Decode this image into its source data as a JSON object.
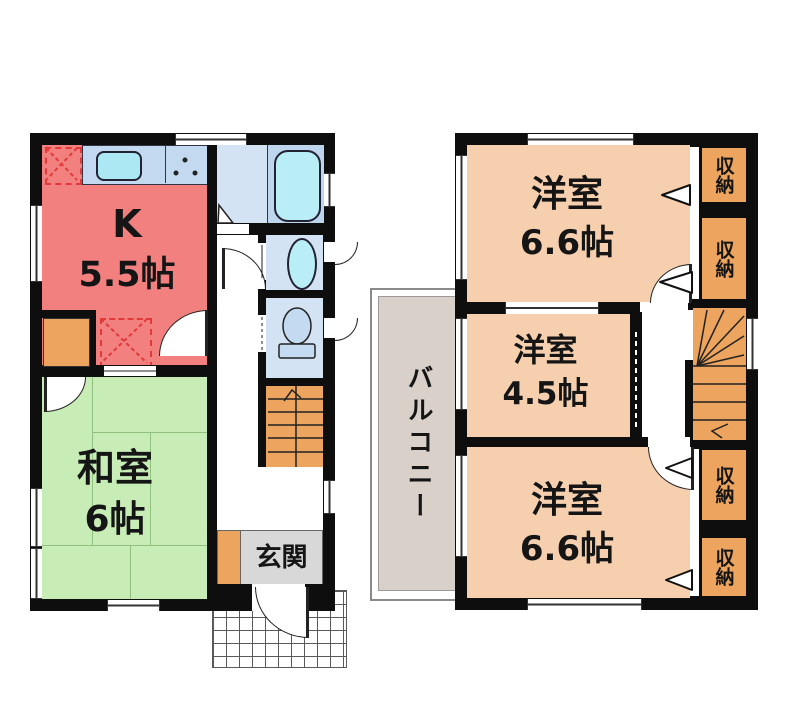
{
  "floor1": {
    "kitchen": {
      "label": "K",
      "size": "5.5帖"
    },
    "washitsu": {
      "label": "和室",
      "size": "6帖"
    },
    "genkan": {
      "label": "玄関"
    }
  },
  "floor2": {
    "room_top": {
      "label": "洋室",
      "size": "6.6帖"
    },
    "room_middle": {
      "label": "洋室",
      "size": "4.5帖"
    },
    "room_bottom": {
      "label": "洋室",
      "size": "6.6帖"
    },
    "balcony": {
      "label": "バルコニー"
    },
    "storages": [
      "収納",
      "収納",
      "収納",
      "収納"
    ]
  },
  "colors": {
    "wall": "#0e0e0e",
    "kitchen": "#f1807f",
    "counter": "#c3d9ef",
    "sink": "#abe8f3",
    "bath": "#d3e3f4",
    "bath_inner": "#bdd5ed",
    "tub": "#b9eef7",
    "tatami": "#c8ecb6",
    "tatami_line": "#8fc07e",
    "orange": "#eca45e",
    "tan": "#f5cfae",
    "balcony": "#d9d1c9",
    "genkan": "#d8d8d8",
    "grid_line": "#5a5a5a",
    "dash_red": "#e03a3a",
    "line": "#222222"
  }
}
